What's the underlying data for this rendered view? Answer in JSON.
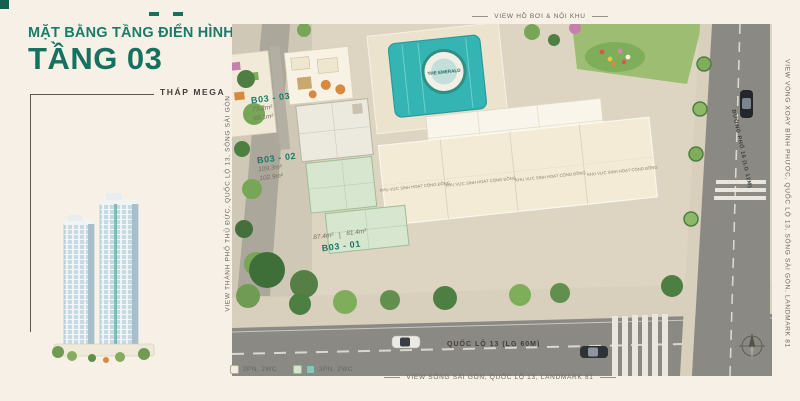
{
  "window": {
    "bg": "#f6f0e6"
  },
  "colors": {
    "accent_teal": "#1b7b68",
    "unit_green_fill": "#d6e6cf",
    "unit_green_border": "#9cbd94",
    "pool_teal": "#35b4b4",
    "road_gray": "#8a8984",
    "text_dark": "#4a463d",
    "text_muted": "#77705f"
  },
  "header": {
    "title_line1": "MẶT BẰNG TẦNG ĐIỂN HÌNH",
    "title_line2": "TẦNG 03",
    "tower_label": "THÁP MEGA"
  },
  "captions": {
    "top": "VIEW HỒ BƠI & NỘI KHU",
    "bottom": "VIEW SÔNG SÀI GÒN, QUỐC LỘ 13, LANDMARK 81",
    "left": "VIEW THÀNH PHỐ THỦ ĐỨC, QUỐC LỘ 13, SÔNG SÀI GÒN",
    "right": "VIEW VÒNG XOAY BÌNH PHƯỚC, QUỐC LỘ 13, SÔNG SÀI GÒN, LANDMARK 81"
  },
  "units": [
    {
      "id": "B03 - 03",
      "area_gross": "73.2m²",
      "area_net": "69.1m²"
    },
    {
      "id": "B03 - 02",
      "area_gross": "109.3m²",
      "area_net": "102.9m²"
    },
    {
      "id": "B03 - 01",
      "area_gross": "87.4m²",
      "area_net": "81.4m²"
    }
  ],
  "map": {
    "badge": "THE EMERALD",
    "community_area": "KHU VỰC SINH HOẠT CỘNG ĐỒNG",
    "highway_label": "QUỐC LỘ 13 (LG 60M)",
    "street_label": "ĐƯỜNG PHỐ 16 (LG 12M)"
  },
  "legend": [
    {
      "label": "2PN, 2WC"
    },
    {
      "label": "3PN, 2WC"
    }
  ]
}
